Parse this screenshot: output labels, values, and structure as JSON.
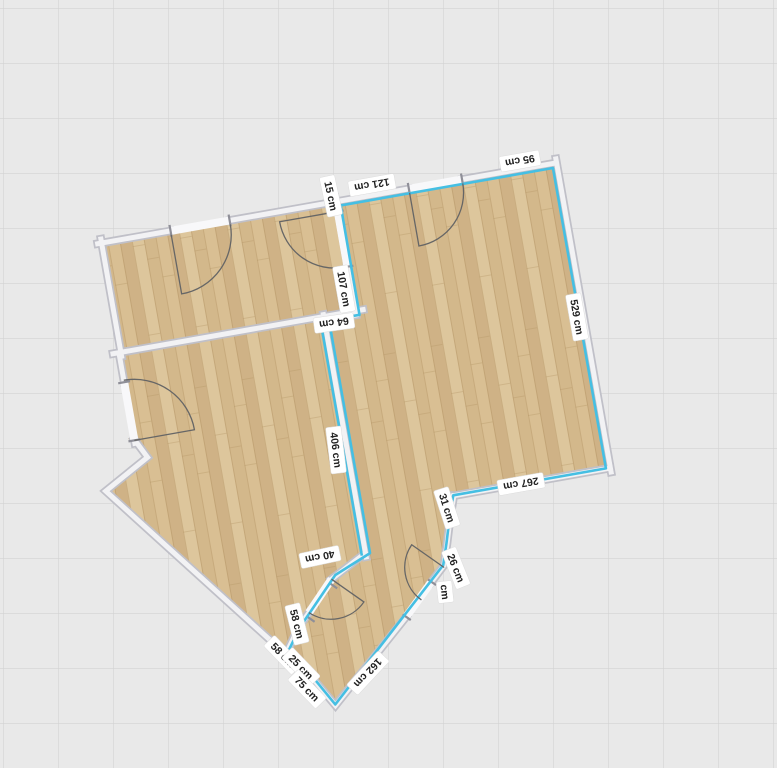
{
  "canvas": {
    "background": "#e9e9e9",
    "grid_line": "#d3d3d3",
    "grid_size_px": 55,
    "selection_color": "#45bfe3",
    "wall_fill": "#f2f2f4",
    "wall_edge": "#c0c0c8",
    "floor_plank_colors": [
      "#d9bf93",
      "#cfb286",
      "#ddc69c",
      "#d3b88b"
    ],
    "door_arc_color": "#666666",
    "label_bg": "#ffffff",
    "label_text_color": "#222222",
    "unit": "cm"
  },
  "floorplan": {
    "selected_room_perimeter_labels": true,
    "dimension_labels": [
      {
        "text": "cm",
        "x": 445,
        "y": 592,
        "rot": 84
      },
      {
        "text": "31 cm",
        "x": 447,
        "y": 508,
        "rot": 72
      },
      {
        "text": "26 cm",
        "x": 456,
        "y": 568,
        "rot": 68
      },
      {
        "text": "267 cm",
        "x": 521,
        "y": 484,
        "rot": 170
      },
      {
        "text": "529 cm",
        "x": 577,
        "y": 317,
        "rot": 80
      },
      {
        "text": "95 cm",
        "x": 520,
        "y": 161,
        "rot": 170
      },
      {
        "text": "121 cm",
        "x": 372,
        "y": 185,
        "rot": 170
      },
      {
        "text": "15 cm",
        "x": 331,
        "y": 196,
        "rot": 78
      },
      {
        "text": "107 cm",
        "x": 344,
        "y": 289,
        "rot": 80
      },
      {
        "text": "64 cm",
        "x": 334,
        "y": 323,
        "rot": 172
      },
      {
        "text": "406 cm",
        "x": 336,
        "y": 450,
        "rot": 83
      },
      {
        "text": "58 cm",
        "x": 297,
        "y": 624,
        "rot": 76
      },
      {
        "text": "40 cm",
        "x": 320,
        "y": 557,
        "rot": 168
      },
      {
        "text": "58 cm",
        "x": 283,
        "y": 655,
        "rot": 46
      },
      {
        "text": "25 cm",
        "x": 301,
        "y": 667,
        "rot": 46
      },
      {
        "text": "75 cm",
        "x": 307,
        "y": 689,
        "rot": 46
      },
      {
        "text": "162 cm",
        "x": 368,
        "y": 673,
        "rot": 133
      }
    ]
  }
}
